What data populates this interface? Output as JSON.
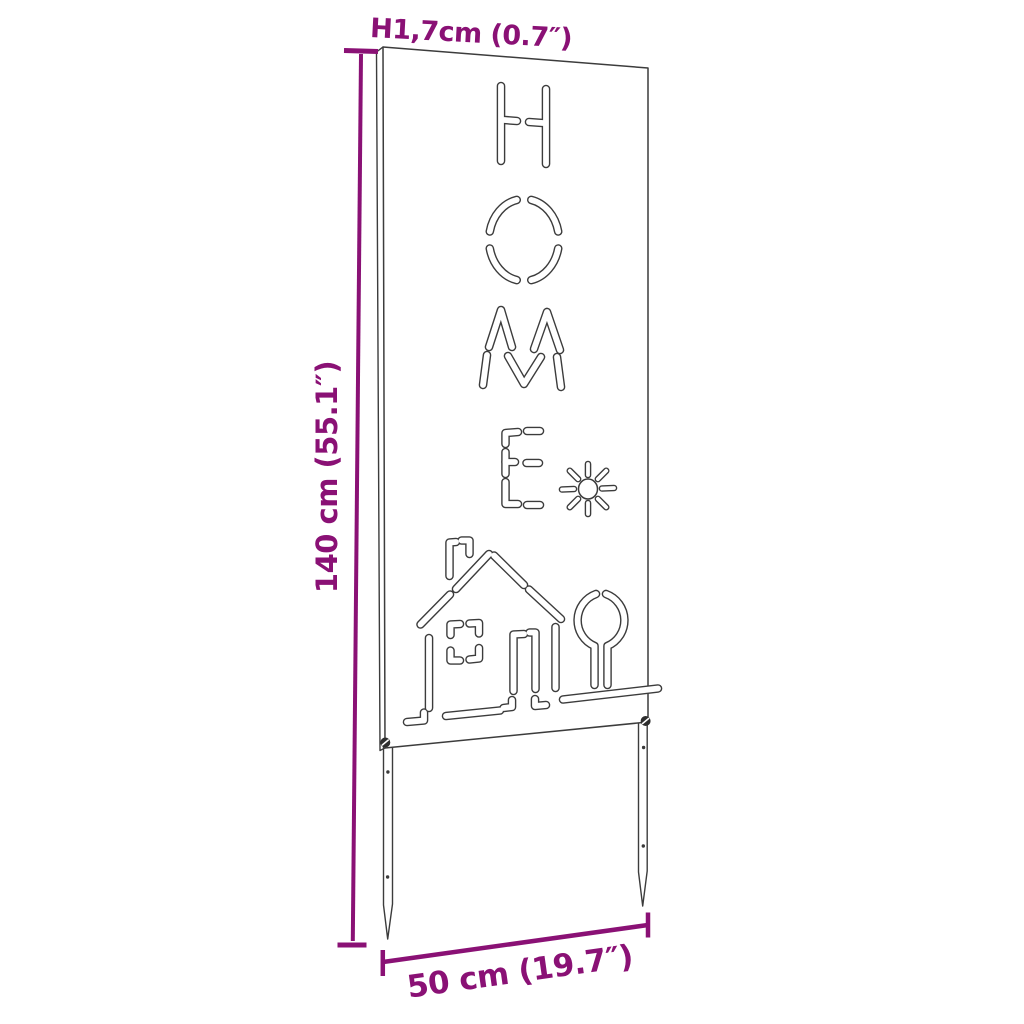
{
  "diagram": {
    "panel_cutout_text": "HOME",
    "panel_cutout_icons": [
      "sun-icon",
      "chimney-icon",
      "house-icon",
      "window-icon",
      "door-icon",
      "tree-icon",
      "ground-icon"
    ]
  },
  "dimensions": {
    "height": "140 cm (55.1″)",
    "width": "50 cm (19.7″)",
    "thickness": "1,7cm (0.7″)",
    "thickness_marker": "H"
  },
  "colors": {
    "accent": "#8a1175",
    "line_art": "#3c3c3c",
    "background": "#ffffff"
  }
}
